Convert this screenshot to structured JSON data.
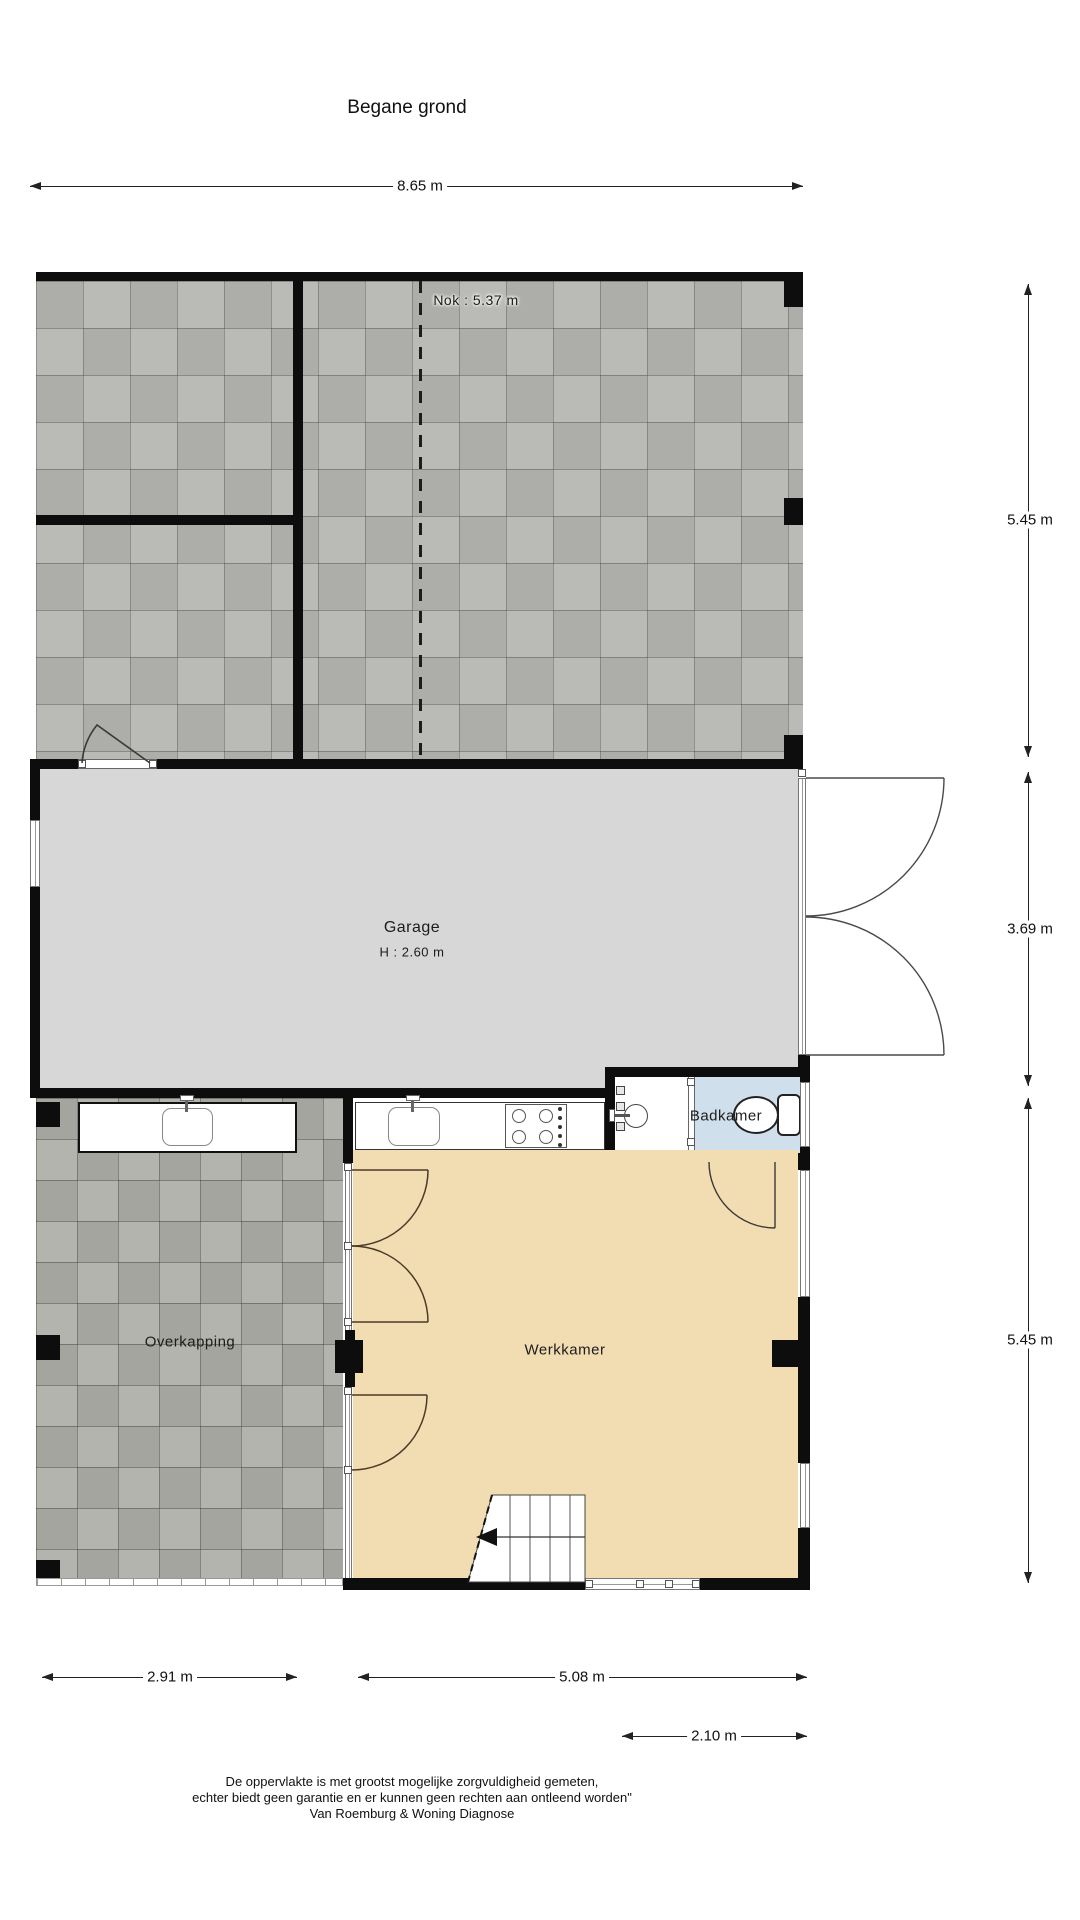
{
  "title": "Begane grond",
  "roof": {
    "nok_label": "Nok : 5.37 m"
  },
  "rooms": {
    "garage": {
      "label": "Garage",
      "height": "H : 2.60 m"
    },
    "badkamer": {
      "label": "Badkamer"
    },
    "overkapping": {
      "label": "Overkapping"
    },
    "werkkamer": {
      "label": "Werkkamer"
    }
  },
  "dimensions": {
    "top_width": "8.65 m",
    "right_top": "5.45 m",
    "right_middle": "3.69 m",
    "right_bottom": "5.45 m",
    "bottom_overkapping": "2.91 m",
    "bottom_werkkamer": "5.08 m",
    "bottom_badkamer": "2.10 m"
  },
  "footer": {
    "line1": "De oppervlakte is met grootst mogelijke zorgvuldigheid gemeten,",
    "line2": "echter biedt geen garantie en er kunnen geen rechten aan ontleend worden\"",
    "line3": "Van Roemburg & Woning Diagnose"
  },
  "colors": {
    "wall": "#0d0d0d",
    "garage_floor": "#d7d7d7",
    "werkkamer_floor": "#f2dcb2",
    "badkamer_floor": "#cfdfec",
    "roof_tiles": "#b6b6b2",
    "overkapping_tiles": "#aeaea8"
  }
}
